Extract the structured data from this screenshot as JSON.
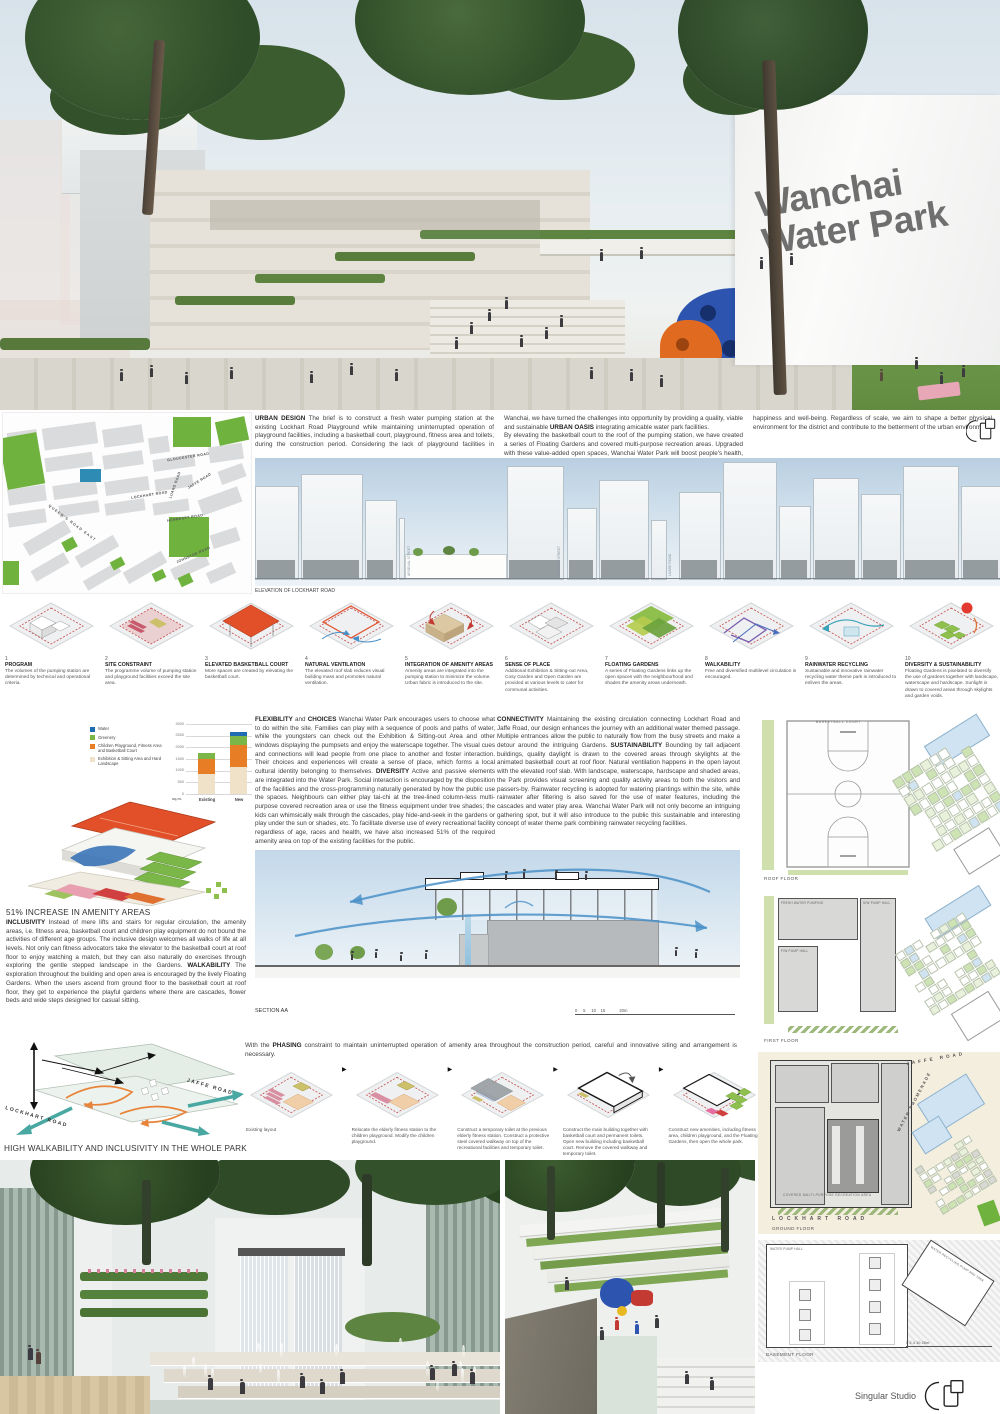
{
  "board": {
    "title_line1": "Wanchai",
    "title_line2": "Water Park",
    "studio": "Singular Studio"
  },
  "texts": {
    "urban1": {
      "b1": "URBAN DESIGN",
      "t1": " The brief is to construct a fresh water pumping station at the existing Lockhart Road Playground while maintaining uninterrupted operation of playground facilities, including a basketball court, playground, fitness area and toilets, during the construction period. Considering the lack of playground facilities in Wanchai, we have turned the challenges into opportunity by providing a quality, viable and sustainable ",
      "b2": "URBAN OASIS",
      "t2": " integrating amicable water park facilities."
    },
    "urban2": "By elevating the basketball court to the roof of the pumping station, we have created a series of Floating Gardens and covered multi-purpose recreation areas. Upgraded with these value-added open spaces, Wanchai Water Park will boost people's health, happiness and well-being. Regardless of scale, we aim to shape a better physical environment for the district and contribute to the betterment of the urban environment.",
    "flex": {
      "b1": "FLEXIBILITY",
      "t1": " and ",
      "b2": "CHOICES",
      "t2": " Wanchai Water Park encourages users to choose what to do within the site. Families can play with a sequence of pools and paths of water, while the youngsters can check out the Exhibition & Sitting-out Area and other windows displaying the pumpsets and enjoy the waterscape together. The visual cues and connections will lead people from one place to another and foster interaction. Their choices and experiences will create a sense of place, which forms a local cultural identity belonging to themselves.  ",
      "b3": "DIVERSITY",
      "t3": " Active and passive elements are integrated into the Water Park. Social interaction is encouraged by the disposition of the facilities and the cross-programming naturally generated by how the public use the spaces. Neighbours can either play tai-chi at the tree-lined column-less multi-purpose covered recreation area or use the fitness equipment under tree shades; the kids can whimsically walk through the cascades, play hide-and-seek in the gardens or play under the sun or shades, etc. To facilitate diverse use of every recreational facility regardless of age, races and health, we have also increased 51% of the required amenity area on top of the existing facilities for the public."
    },
    "conn": {
      "b1": "CONNECTIVITY",
      "t1": " Maintaining the existing circulation connecting Lockhart Road and Jaffe Road, our design enhances the journey with an additional water themed passage. Multiple entrances allow the public to naturally flow from the busy streets and make a detour around the intriguing Gardens.  ",
      "b2": "SUSTAINABILITY",
      "t2": " Bounding by tall adjacent buildings, quality daylight is drawn to the covered areas through skylights at the animated basketball court at roof floor. Natural ventilation happens in the open layout with the elevated roof slab. With landscape, waterscape, hardscape and shaded areas, the Park provides visual screening and quality activity areas to both the visitors and passers-by. Rainwater recycling is adopted for watering plantings within the site, while rainwater after filtering is also saved for the use of water features, including the cascades and water play area. Wanchai Water Park will not only become an intriguing gathering spot, but it will also introduce to the public this sustainable and interesting concept of water theme park combining rainwater recycling facilities."
    },
    "amenity_heading": "51% INCREASE IN AMENITY AREAS",
    "amenity": {
      "b1": "INCLUSIVITY",
      "t1": " Instead of mere lifts and stairs for regular circulation, the amenity areas, i.e. fitness area, basketball court and children play equipment do not bound the activities of different age groups. The inclusive design welcomes all walks of life at all levels. Not only can fitness advocators take the elevator to the basketball court at roof floor to enjoy watching a match, but they can also naturally do exercises through exploring the gentle stepped landscape in the Gardens.  ",
      "b2": "WALKABILITY",
      "t2": " The exploration throughout the building and open area is encouraged by the lively Floating Gardens. When the users ascend from ground floor to the basketball court at roof floor, they get to experience the playful gardens where there are cascades, flower beds and wide steps designed for casual sitting."
    },
    "phasing_intro": {
      "t1": "With the ",
      "b1": "PHASING",
      "t2": " constraint to maintain uninterrupted operation of amenity area throughout the construction period, careful and innovative siting and arrangement is necessary."
    }
  },
  "map": {
    "streets": [
      "GLOUCESTER ROAD",
      "JAFFE ROAD",
      "LOCKHART ROAD",
      "HENNESSY ROAD",
      "LUARD ROAD",
      "JOHNSTON ROAD",
      "QUEEN'S ROAD EAST"
    ]
  },
  "elevation": {
    "label": "ELEVATION OF LOCKHART ROAD",
    "streets": [
      "ARSENAL STREET",
      "FENWICK STREET",
      "LUARD ROAD"
    ]
  },
  "concepts": [
    {
      "n": "1",
      "title": "PROGRAM",
      "text": "The volumes of the pumping station are determined by technical and operational criteria."
    },
    {
      "n": "2",
      "title": "SITE CONSTRAINT",
      "text": "The programme volume of pumping station and playground facilities exceed the site area."
    },
    {
      "n": "3",
      "title": "ELEVATED BASKETBALL COURT",
      "text": "More spaces are created by elevating the basketball court."
    },
    {
      "n": "4",
      "title": "NATURAL VENTILATION",
      "text": "The elevated roof slab reduces visual building mass and promotes natural ventilation."
    },
    {
      "n": "5",
      "title": "INTEGRATION OF AMENITY AREAS",
      "text": "Amenity areas are integrated into the pumping station to minimize the volume. Urban fabric is introduced to the site."
    },
    {
      "n": "6",
      "title": "SENSE OF PLACE",
      "text": "Additional Exhibition & Sitting-out Area, Cosy Garden and Open Garden are provided at various levels to cater for communal activities."
    },
    {
      "n": "7",
      "title": "FLOATING GARDENS",
      "text": "A series of Floating Gardens links up the open spaces with the neighbourhood and shades the amenity areas underneath."
    },
    {
      "n": "8",
      "title": "WALKABILITY",
      "text": "Free and diversified multilevel circulation is encouraged."
    },
    {
      "n": "9",
      "title": "RAINWATER RECYCLING",
      "text": "Sustainable and innovative rainwater recycling water theme park is introduced to enliven the areas."
    },
    {
      "n": "10",
      "title": "DIVERSITY & SUSTAINABILITY",
      "text": "Floating Gardens is pixelated to diversify the use of gardens together with landscape, waterscape and hardscape. Sunlight is drawn to covered areas through skylights and garden voids."
    }
  ],
  "section": {
    "label": "SECTION AA",
    "scale": [
      "0",
      "5",
      "10",
      "15",
      "20m"
    ]
  },
  "walkability": {
    "caption": "HIGH WALKABILITY AND INCLUSIVITY IN THE WHOLE PARK",
    "street_left": "LOCKHART ROAD",
    "street_right": "JAFFE ROAD"
  },
  "phasing_steps": [
    "Existing layout",
    "Relocate the elderly fitness station to the children playground. Modify the children playground.",
    "Construct a temporary toilet at the previous elderly fitness station. Construct a protective steel covered walkway on top of the recreational facilities and temporary toilet.",
    "Construct the main building together with basketball court and permanent toilets. Open new building including basketball court. Remove the covered walkway and temporary toilet.",
    "Construct new amenities, including fitness area, children playground, and the Floating Gardens, then open the whole park."
  ],
  "plans": {
    "roof": {
      "label": "ROOF FLOOR",
      "court": "BASKETBALL COURT"
    },
    "first": {
      "label": "FIRST FLOOR",
      "room_a": "FRESH WATER PUMPING",
      "room_b": "F/W PUMP HALL",
      "room_c": "S/W PUMP HALL"
    },
    "ground": {
      "label": "GROUND FLOOR",
      "area": "COVERED MULTI-PURPOSE RECREATION AREA",
      "street_top": "JAFFE ROAD",
      "street_diag": "WATER PROMENADE",
      "street_bottom": "LOCKHART ROAD"
    },
    "basement": {
      "label": "BASEMENT FLOOR",
      "room_a": "WATER PUMP HALL",
      "room_b": "WATER RECYCLING PUMP AND TANK",
      "scale": "0  2  4        10                 20m"
    }
  },
  "chart_data": {
    "type": "bar",
    "stacked": true,
    "categories": [
      "Existing",
      "New"
    ],
    "series": [
      {
        "name": "Water",
        "color": "#1f6cb4",
        "values": [
          0,
          150
        ]
      },
      {
        "name": "Greenery",
        "color": "#7ab648",
        "values": [
          250,
          400
        ]
      },
      {
        "name": "Children Playground, Fitness Area and Basketball Court",
        "color": "#e77e25",
        "values": [
          625,
          950
        ]
      },
      {
        "name": "Exhibition & Sitting Area and Hard Landscape",
        "color": "#f0e2c8",
        "values": [
          875,
          1150
        ]
      }
    ],
    "ylabel": "sq.m.",
    "yticks": [
      0,
      500,
      1000,
      1500,
      2000,
      2500,
      3000
    ],
    "ylim": [
      0,
      3000
    ]
  }
}
